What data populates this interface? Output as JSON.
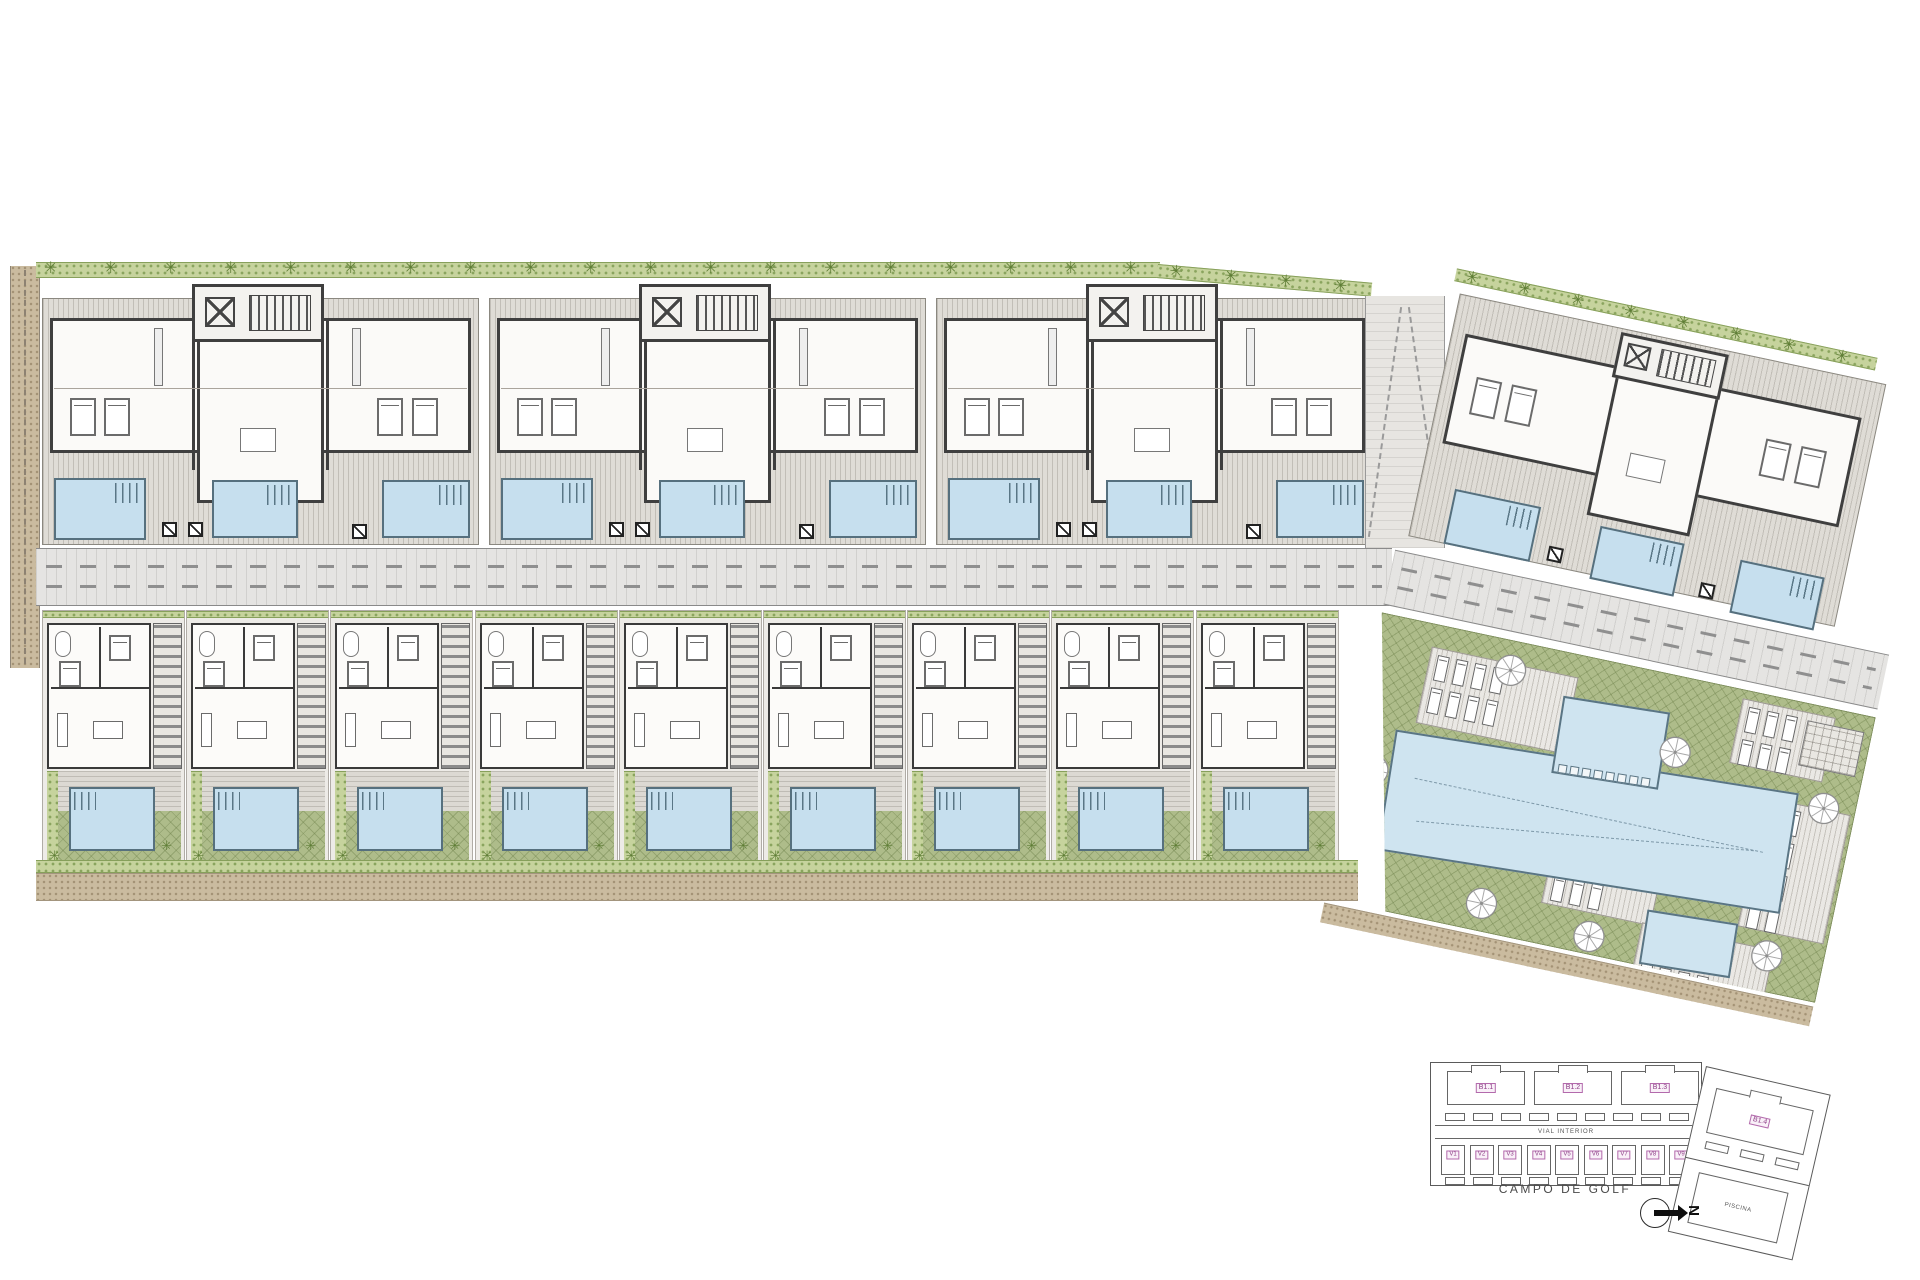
{
  "plan": {
    "type": "residential development site plan",
    "road_label": "VIAL INTERIOR",
    "golf_label": "CAMPO DE GOLF",
    "pool_label": "PISCINA",
    "north_label": "N",
    "blocks": [
      "B1.1",
      "B1.2",
      "B1.3",
      "B1.4"
    ],
    "villas": [
      "V1",
      "V2",
      "V3",
      "V4",
      "V5",
      "V6",
      "V7",
      "V8",
      "V9"
    ]
  },
  "counts": {
    "apartment_blocks_top_row": 3,
    "apartment_blocks_right": 1,
    "villas": 9,
    "pools_per_apartment_block": 3,
    "villa_pools": 9,
    "communal_pools": 3,
    "parasols": 7,
    "lounger_platforms": 5
  },
  "icons": {
    "palm": "✳"
  },
  "colors": {
    "terrace_grey": "#dfdcd6",
    "wall_dark": "#3f3f3f",
    "pool_blue": "#c6dfee",
    "pool_edge": "#56707e",
    "lawn_green": "#aebc8a",
    "hedge_green": "#c6d39d",
    "palm_green": "#5e7d35",
    "road_grey": "#e5e4e2",
    "gravel_tan": "#cabb9f",
    "label_pink": "#8d3d86"
  }
}
